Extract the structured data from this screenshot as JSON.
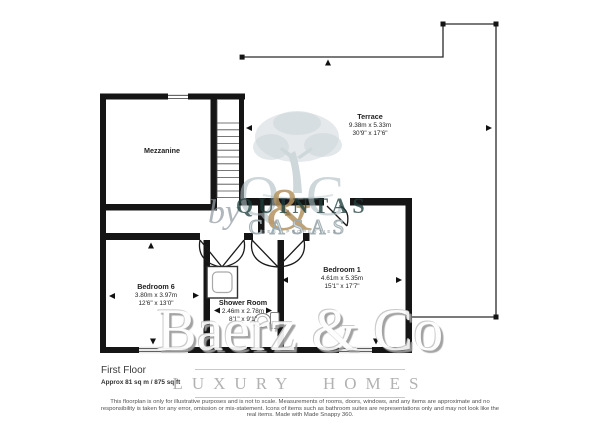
{
  "floorplan": {
    "title": "First Floor",
    "area": "Approx 81 sq m / 875 sq ft",
    "rooms": [
      {
        "name": "Mezzanine",
        "dims_m": "",
        "dims_ft": ""
      },
      {
        "name": "Terrace",
        "dims_m": "9.38m x 5.33m",
        "dims_ft": "30'9\" x 17'6\""
      },
      {
        "name": "Bedroom 6",
        "dims_m": "3.80m x 3.97m",
        "dims_ft": "12'6\" x 13'0\""
      },
      {
        "name": "Shower Room",
        "dims_m": "2.46m x 2.78m",
        "dims_ft": "8'1\" x 9'1\""
      },
      {
        "name": "Bedroom 1",
        "dims_m": "4.61m x 5.35m",
        "dims_ft": "15'1\" x 17'7\""
      }
    ],
    "disclaimer": "This floorplan is only for illustrative purposes and is not to scale. Measurements of rooms, doors, windows, and any items are approximate and no responsibility is taken for any error, omission or mis-statement. Icons of items such as bathroom suites are representations only and may not look like the real items. Made with Made Snappy 360."
  },
  "branding": {
    "agency": "Baerz & Co",
    "tagline": "LUXURY HOMES",
    "watermark": {
      "q": "Q",
      "amp": "&",
      "c": "C",
      "by": "by",
      "word1": "QUINTAS",
      "word2": "CASAS",
      "caption": "BEST PROPERTIES"
    }
  },
  "colors": {
    "wall": "#151515",
    "thin_line": "#2a2a2a",
    "watermark_blue": "#c3ced2",
    "watermark_dark": "#1f403d",
    "gold": "#b4935f",
    "brand_gray": "#9c9c9c"
  }
}
